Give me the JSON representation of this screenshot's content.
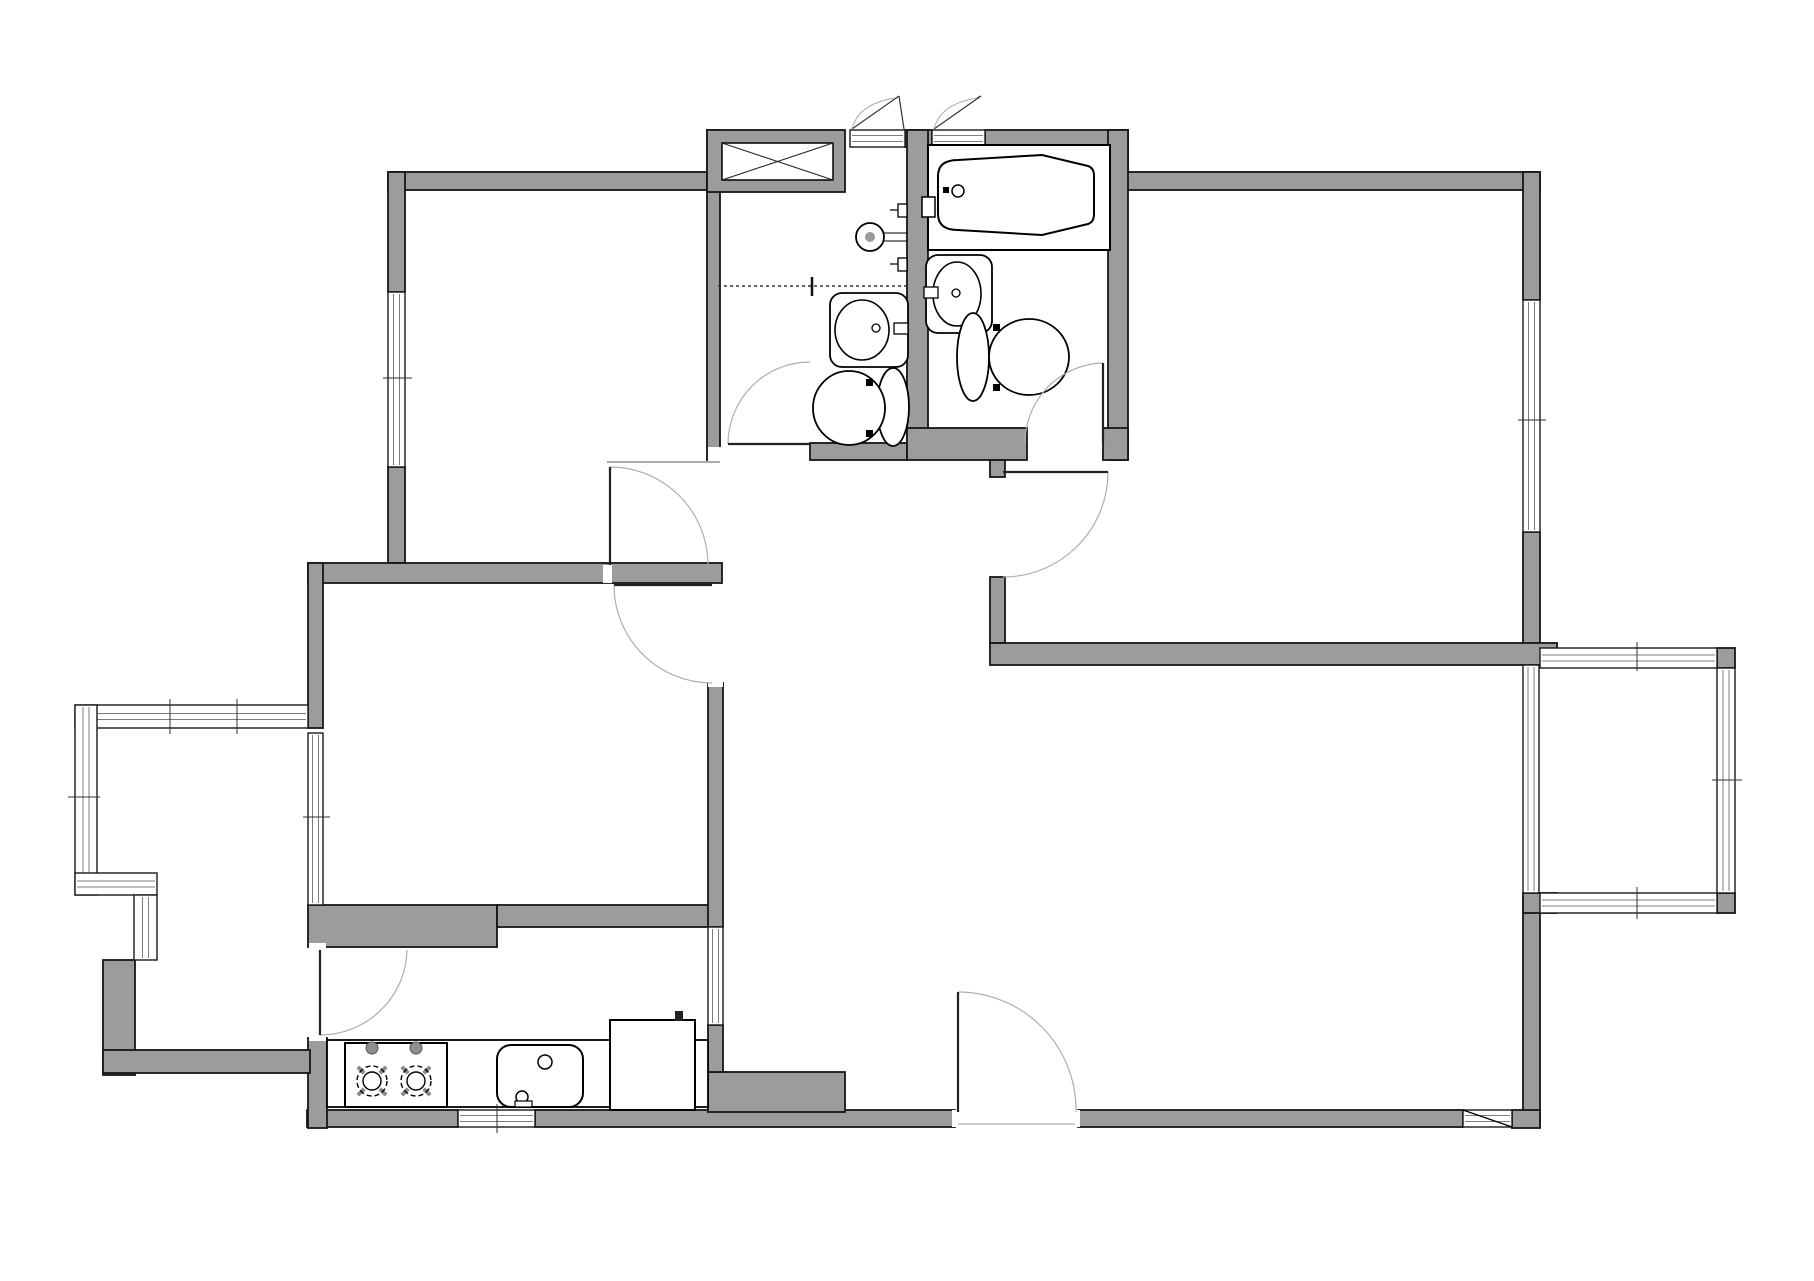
{
  "meta": {
    "kind": "architectural-floor-plan",
    "canvas_w": 1814,
    "canvas_h": 1281
  },
  "palette": {
    "wall_fill": "#9c9c9c",
    "wall_stroke": "#161616",
    "window_fill": "#ffffff",
    "window_stroke": "#1a1a1a",
    "glass_line": "#7d7d7d",
    "door_arc": "#aeaeae",
    "leaf_stroke": "#222222",
    "fixture_stroke": "#000000",
    "fixture_fill": "#ffffff",
    "tick_stroke": "#333333",
    "faint": "#999999",
    "knob_fill": "#8f8f8f",
    "burner_tick": "#8a8a8a"
  },
  "plan": {
    "walls": [
      {
        "x": 388,
        "y": 172,
        "w": 319,
        "h": 18,
        "n": "bedroom1-north-wall"
      },
      {
        "x": 388,
        "y": 172,
        "w": 17,
        "h": 120,
        "n": "bedroom1-west-wall-upper"
      },
      {
        "x": 388,
        "y": 467,
        "w": 17,
        "h": 96,
        "n": "bedroom1-west-wall-lower"
      },
      {
        "x": 308,
        "y": 563,
        "w": 414,
        "h": 20,
        "n": "bedroom1-south-wall"
      },
      {
        "x": 308,
        "y": 563,
        "w": 15,
        "h": 165,
        "n": "bedroom2-west-wall"
      },
      {
        "x": 707,
        "y": 130,
        "w": 13,
        "h": 330,
        "n": "bath-column-west-wall"
      },
      {
        "x": 707,
        "y": 130,
        "w": 138,
        "h": 62,
        "n": "duct-closet-block"
      },
      {
        "x": 905,
        "y": 130,
        "w": 27,
        "h": 17,
        "n": "bath-top-wall-stub"
      },
      {
        "x": 985,
        "y": 130,
        "w": 143,
        "h": 17,
        "n": "bath2-top-wall"
      },
      {
        "x": 1110,
        "y": 130,
        "w": 18,
        "h": 60,
        "n": "top-step-wall"
      },
      {
        "x": 1110,
        "y": 172,
        "w": 430,
        "h": 18,
        "n": "master-north-wall"
      },
      {
        "x": 1523,
        "y": 172,
        "w": 17,
        "h": 128,
        "n": "east-wall-upper"
      },
      {
        "x": 1523,
        "y": 532,
        "w": 17,
        "h": 116,
        "n": "east-wall-mid"
      },
      {
        "x": 990,
        "y": 643,
        "w": 567,
        "h": 22,
        "n": "master-south-wall"
      },
      {
        "x": 990,
        "y": 577,
        "w": 15,
        "h": 66,
        "n": "master-west-stub-wall"
      },
      {
        "x": 1108,
        "y": 130,
        "w": 20,
        "h": 330,
        "n": "bath2-east-wall"
      },
      {
        "x": 907,
        "y": 130,
        "w": 21,
        "h": 313,
        "n": "bath-dividing-wall"
      },
      {
        "x": 810,
        "y": 443,
        "w": 97,
        "h": 17,
        "n": "bath1-south-wall"
      },
      {
        "x": 907,
        "y": 428,
        "w": 120,
        "h": 32,
        "n": "bath2-south-wall"
      },
      {
        "x": 1103,
        "y": 428,
        "w": 25,
        "h": 32,
        "n": "bath2-se-corner"
      },
      {
        "x": 990,
        "y": 460,
        "w": 15,
        "h": 17,
        "n": "master-door-jamb"
      },
      {
        "x": 1523,
        "y": 897,
        "w": 17,
        "h": 230,
        "n": "east-wall-lower"
      },
      {
        "x": 1078,
        "y": 1110,
        "w": 385,
        "h": 17,
        "n": "south-wall-right"
      },
      {
        "x": 1512,
        "y": 1110,
        "w": 28,
        "h": 18,
        "n": "south-wall-se-corner"
      },
      {
        "x": 535,
        "y": 1110,
        "w": 420,
        "h": 17,
        "n": "south-wall-center"
      },
      {
        "x": 708,
        "y": 1072,
        "w": 137,
        "h": 40,
        "n": "entry-step-block"
      },
      {
        "x": 307,
        "y": 1110,
        "w": 151,
        "h": 17,
        "n": "kitchen-south-wall"
      },
      {
        "x": 308,
        "y": 905,
        "w": 189,
        "h": 42,
        "n": "bedroom2-south-wall-left"
      },
      {
        "x": 497,
        "y": 905,
        "w": 225,
        "h": 22,
        "n": "bedroom2-south-wall-right"
      },
      {
        "x": 308,
        "y": 1038,
        "w": 19,
        "h": 90,
        "n": "kitchen-west-wall"
      },
      {
        "x": 708,
        "y": 683,
        "w": 15,
        "h": 244,
        "n": "bedroom2-east-wall"
      },
      {
        "x": 708,
        "y": 1025,
        "w": 15,
        "h": 47,
        "n": "kitchen-east-wall"
      },
      {
        "x": 103,
        "y": 960,
        "w": 32,
        "h": 115,
        "n": "corridor-west-wall"
      },
      {
        "x": 103,
        "y": 1050,
        "w": 207,
        "h": 23,
        "n": "corridor-south-wall"
      },
      {
        "x": 1717,
        "y": 648,
        "w": 18,
        "h": 20,
        "n": "rbalcony-ne-post"
      },
      {
        "x": 1717,
        "y": 893,
        "w": 18,
        "h": 20,
        "n": "rbalcony-se-post"
      },
      {
        "x": 1523,
        "y": 893,
        "w": 34,
        "h": 20,
        "n": "rbalcony-sw-post"
      }
    ],
    "windows": [
      {
        "x": 388,
        "y": 292,
        "w": 17,
        "h": 175,
        "o": "v",
        "n": "bedroom1-west-window"
      },
      {
        "x": 1523,
        "y": 300,
        "w": 17,
        "h": 232,
        "o": "v",
        "n": "master-east-window"
      },
      {
        "x": 458,
        "y": 1110,
        "w": 77,
        "h": 17,
        "o": "h",
        "n": "kitchen-south-window"
      },
      {
        "x": 1463,
        "y": 1110,
        "w": 49,
        "h": 17,
        "o": "h",
        "n": "living-south-window"
      },
      {
        "x": 708,
        "y": 927,
        "w": 15,
        "h": 98,
        "o": "v",
        "n": "kitchen-east-window"
      },
      {
        "x": 850,
        "y": 130,
        "w": 55,
        "h": 17,
        "o": "h",
        "n": "bath1-top-threshold"
      },
      {
        "x": 932,
        "y": 130,
        "w": 53,
        "h": 17,
        "o": "h",
        "n": "bath2-top-threshold"
      },
      {
        "x": 75,
        "y": 705,
        "w": 233,
        "h": 23,
        "o": "h",
        "n": "lbalcony-north-glazing"
      },
      {
        "x": 75,
        "y": 705,
        "w": 22,
        "h": 190,
        "o": "v",
        "n": "lbalcony-west-glazing"
      },
      {
        "x": 75,
        "y": 873,
        "w": 82,
        "h": 22,
        "o": "h",
        "n": "lbalcony-south-glazing"
      },
      {
        "x": 134,
        "y": 895,
        "w": 23,
        "h": 65,
        "o": "v",
        "n": "lbalcony-return-glazing"
      },
      {
        "x": 308,
        "y": 733,
        "w": 15,
        "h": 172,
        "o": "v",
        "n": "bedroom2-balcony-window"
      },
      {
        "x": 1540,
        "y": 648,
        "w": 177,
        "h": 20,
        "o": "h",
        "n": "rbalcony-north-glazing"
      },
      {
        "x": 1717,
        "y": 668,
        "w": 18,
        "h": 225,
        "o": "v",
        "n": "rbalcony-east-glazing"
      },
      {
        "x": 1540,
        "y": 893,
        "w": 177,
        "h": 20,
        "o": "h",
        "n": "rbalcony-south-glazing"
      },
      {
        "x": 1523,
        "y": 665,
        "w": 16,
        "h": 228,
        "o": "v",
        "n": "living-balcony-glazing"
      }
    ],
    "thresholds": [
      {
        "x": 708,
        "y": 447,
        "w": 20,
        "h": 15
      },
      {
        "x": 603,
        "y": 565,
        "w": 9,
        "h": 18
      },
      {
        "x": 708,
        "y": 679,
        "w": 15,
        "h": 8
      },
      {
        "x": 309,
        "y": 943,
        "w": 17,
        "h": 8
      },
      {
        "x": 309,
        "y": 1033,
        "w": 17,
        "h": 8
      },
      {
        "x": 952,
        "y": 1110,
        "w": 10,
        "h": 17
      },
      {
        "x": 1070,
        "y": 1110,
        "w": 10,
        "h": 17
      }
    ],
    "doors": [
      {
        "n": "bathroom1-door",
        "leaf": [
          810,
          444,
          728,
          444
        ],
        "arc": "M728 444 A82 82 0 0 1 810 362"
      },
      {
        "n": "bedroom1-door",
        "leaf": [
          610,
          565,
          610,
          467
        ],
        "arc": "M610 467 A98 98 0 0 1 708 565"
      },
      {
        "n": "bedroom2-door",
        "leaf": [
          712,
          585,
          614,
          585
        ],
        "arc": "M614 585 A98 98 0 0 0 712 683"
      },
      {
        "n": "master-suite-door",
        "leaf": [
          1003,
          472,
          1108,
          472
        ],
        "arc": "M1108 472 A105 105 0 0 1 1003 577"
      },
      {
        "n": "ensuite-bath-door",
        "leaf": [
          1103,
          443,
          1103,
          363
        ],
        "arc": "M1103 363 A80 80 0 0 0 1025 443"
      },
      {
        "n": "kitchen-door",
        "leaf": [
          320,
          950,
          320,
          1035
        ],
        "arc": "M320 1035 A87 87 0 0 0 407 950"
      },
      {
        "n": "entry-door",
        "leaf": [
          958,
          1112,
          958,
          992
        ],
        "arc": "M958 992 A118 118 0 0 1 1076 1112"
      }
    ],
    "casements": [
      {
        "n": "bath1-top-vent",
        "lines": [
          [
            852,
            129,
            899,
            96
          ],
          [
            899,
            96,
            904,
            129
          ]
        ],
        "curve": "M852 129 Q858 104 895 98"
      },
      {
        "n": "bath2-top-vent",
        "lines": [
          [
            934,
            129,
            981,
            96
          ],
          [
            981,
            96,
            977,
            98
          ]
        ],
        "curve": "M934 129 Q940 104 977 98"
      }
    ],
    "lines": [
      {
        "x1": 718,
        "y1": 286,
        "x2": 907,
        "y2": 286,
        "sw": 1.5,
        "c": "#333333",
        "dash": "3 3",
        "n": "bath1-shower-divider"
      },
      {
        "x1": 812,
        "y1": 277,
        "x2": 812,
        "y2": 296,
        "sw": 2.5,
        "c": "#111111",
        "n": "divider-tick"
      },
      {
        "x1": 930,
        "y1": 240,
        "x2": 1108,
        "y2": 240,
        "sw": 1,
        "c": "#333333",
        "dash": "3 3",
        "n": "tub-apron-line"
      },
      {
        "x1": 607,
        "y1": 462,
        "x2": 720,
        "y2": 462,
        "sw": 1,
        "c": "#555555",
        "n": "hall-partition-line"
      },
      {
        "x1": 958,
        "y1": 1124,
        "x2": 1075,
        "y2": 1124,
        "sw": 1,
        "c": "#999999",
        "n": "entry-threshold-line"
      },
      {
        "x1": 1463,
        "y1": 1110,
        "x2": 1512,
        "y2": 1127,
        "sw": 1.2,
        "c": "#000000",
        "n": "window-diagonal"
      },
      {
        "x1": 884,
        "y1": 233,
        "x2": 907,
        "y2": 233,
        "sw": 1,
        "c": "#000000",
        "n": "shower-pipe-a"
      },
      {
        "x1": 884,
        "y1": 241,
        "x2": 907,
        "y2": 241,
        "sw": 1,
        "c": "#000000",
        "n": "shower-pipe-b"
      },
      {
        "x1": 610,
        "y1": 1028,
        "x2": 695,
        "y2": 1028,
        "sw": 1,
        "c": "#000000",
        "n": "appliance-line-a"
      },
      {
        "x1": 610,
        "y1": 1038,
        "x2": 695,
        "y2": 1038,
        "sw": 1,
        "c": "#000000",
        "n": "appliance-line-b"
      },
      {
        "x1": 890,
        "y1": 210,
        "x2": 898,
        "y2": 210,
        "sw": 1.2,
        "c": "#000000",
        "n": "handle-stem-a"
      },
      {
        "x1": 890,
        "y1": 264,
        "x2": 898,
        "y2": 264,
        "sw": 1.2,
        "c": "#000000",
        "n": "handle-stem-b"
      },
      {
        "x1": 894,
        "y1": 328,
        "x2": 878,
        "y2": 328,
        "sw": 1.4,
        "c": "#000000",
        "n": "sink1-spout"
      },
      {
        "x1": 938,
        "y1": 293,
        "x2": 954,
        "y2": 293,
        "sw": 1.4,
        "c": "#000000",
        "n": "sink2-spout"
      },
      {
        "x1": 534,
        "y1": 1058,
        "x2": 521,
        "y2": 1095,
        "sw": 3,
        "c": "#000000",
        "n": "ksink-lever"
      }
    ],
    "fixtures": [
      {
        "t": "rect",
        "x": 928,
        "y": 145,
        "w": 182,
        "h": 105,
        "sw": 2,
        "n": "bathtub-platform"
      },
      {
        "t": "path",
        "d": "M958 160 L1042 155 L1088 166 Q1094 168 1094 176 L1094 214 Q1094 222 1088 224 L1042 235 L958 230 Q938 230 938 214 L938 176 Q938 160 958 160 Z",
        "sw": 2,
        "n": "bathtub"
      },
      {
        "t": "circle",
        "cx": 958,
        "cy": 191,
        "r": 6,
        "sw": 1.5,
        "n": "tub-drain"
      },
      {
        "t": "rect",
        "x": 943,
        "y": 187,
        "w": 6,
        "h": 6,
        "fill": "#000000",
        "sw": 0,
        "n": "tub-dot"
      },
      {
        "t": "rect",
        "x": 922,
        "y": 197,
        "w": 13,
        "h": 20,
        "sw": 1.5,
        "n": "tub-faucet"
      },
      {
        "t": "circle",
        "cx": 870,
        "cy": 237,
        "r": 14,
        "sw": 1.8,
        "n": "shower-drain"
      },
      {
        "t": "circle",
        "cx": 870,
        "cy": 237,
        "r": 5,
        "fill": "#999999",
        "sw": 0,
        "n": "shower-drain-dot"
      },
      {
        "t": "rect",
        "x": 898,
        "y": 204,
        "w": 9,
        "h": 13,
        "sw": 1.3,
        "n": "shower-handle-a"
      },
      {
        "t": "rect",
        "x": 898,
        "y": 258,
        "w": 9,
        "h": 13,
        "sw": 1.3,
        "n": "shower-handle-b"
      },
      {
        "t": "rect",
        "x": 830,
        "y": 293,
        "w": 78,
        "h": 74,
        "rx": 12,
        "sw": 1.8,
        "n": "bath1-vanity"
      },
      {
        "t": "ellipse",
        "cx": 862,
        "cy": 330,
        "rx": 27,
        "ry": 30,
        "sw": 1.6,
        "n": "bath1-basin"
      },
      {
        "t": "rect",
        "x": 894,
        "y": 323,
        "w": 14,
        "h": 11,
        "sw": 1.3,
        "n": "bath1-faucet"
      },
      {
        "t": "circle",
        "cx": 876,
        "cy": 328,
        "r": 4,
        "sw": 1.3,
        "n": "bath1-faucet-knob"
      },
      {
        "t": "rect",
        "x": 926,
        "y": 255,
        "w": 66,
        "h": 78,
        "rx": 12,
        "sw": 1.8,
        "n": "bath2-vanity"
      },
      {
        "t": "ellipse",
        "cx": 957,
        "cy": 294,
        "rx": 24,
        "ry": 32,
        "sw": 1.6,
        "n": "bath2-basin"
      },
      {
        "t": "rect",
        "x": 924,
        "y": 287,
        "w": 14,
        "h": 11,
        "sw": 1.3,
        "n": "bath2-faucet"
      },
      {
        "t": "circle",
        "cx": 956,
        "cy": 293,
        "r": 4,
        "sw": 1.3,
        "n": "bath2-faucet-knob"
      },
      {
        "t": "ellipse",
        "cx": 893,
        "cy": 407,
        "rx": 16,
        "ry": 39,
        "sw": 1.8,
        "n": "toilet1-tank"
      },
      {
        "t": "ellipse",
        "cx": 849,
        "cy": 408,
        "rx": 36,
        "ry": 37,
        "sw": 1.8,
        "n": "toilet1-bowl"
      },
      {
        "t": "rect",
        "x": 866,
        "y": 379,
        "w": 7,
        "h": 7,
        "fill": "#000000",
        "sw": 0,
        "n": "toilet1-hinge-a"
      },
      {
        "t": "rect",
        "x": 866,
        "y": 430,
        "w": 7,
        "h": 7,
        "fill": "#000000",
        "sw": 0,
        "n": "toilet1-hinge-b"
      },
      {
        "t": "ellipse",
        "cx": 973,
        "cy": 357,
        "rx": 16,
        "ry": 44,
        "sw": 1.8,
        "n": "toilet2-tank"
      },
      {
        "t": "ellipse",
        "cx": 1029,
        "cy": 357,
        "rx": 40,
        "ry": 38,
        "sw": 1.8,
        "n": "toilet2-bowl"
      },
      {
        "t": "rect",
        "x": 993,
        "y": 324,
        "w": 7,
        "h": 7,
        "fill": "#000000",
        "sw": 0,
        "n": "toilet2-hinge-a"
      },
      {
        "t": "rect",
        "x": 993,
        "y": 384,
        "w": 7,
        "h": 7,
        "fill": "#000000",
        "sw": 0,
        "n": "toilet2-hinge-b"
      },
      {
        "t": "rect",
        "x": 327,
        "y": 1040,
        "w": 381,
        "h": 67,
        "sw": 1.8,
        "n": "kitchen-counter"
      },
      {
        "t": "rect",
        "x": 345,
        "y": 1043,
        "w": 102,
        "h": 64,
        "sw": 2,
        "n": "cooktop"
      },
      {
        "t": "circle",
        "cx": 372,
        "cy": 1048,
        "r": 6,
        "fill": "#8f8f8f",
        "sw": 1,
        "stroke": "#555555",
        "n": "cooktop-knob-a"
      },
      {
        "t": "circle",
        "cx": 416,
        "cy": 1048,
        "r": 6,
        "fill": "#8f8f8f",
        "sw": 1,
        "stroke": "#555555",
        "n": "cooktop-knob-b"
      },
      {
        "t": "burner",
        "cx": 372,
        "cy": 1081,
        "r": 15,
        "n": "burner-left"
      },
      {
        "t": "burner",
        "cx": 416,
        "cy": 1081,
        "r": 15,
        "n": "burner-right"
      },
      {
        "t": "rect",
        "x": 497,
        "y": 1045,
        "w": 86,
        "h": 62,
        "rx": 14,
        "sw": 2,
        "n": "kitchen-sink"
      },
      {
        "t": "circle",
        "cx": 545,
        "cy": 1062,
        "r": 7,
        "sw": 1.5,
        "n": "ksink-faucet"
      },
      {
        "t": "circle",
        "cx": 522,
        "cy": 1097,
        "r": 6,
        "sw": 1.5,
        "n": "ksink-drain"
      },
      {
        "t": "rect",
        "x": 515,
        "y": 1101,
        "w": 17,
        "h": 6,
        "sw": 1.2,
        "n": "ksink-strainer"
      },
      {
        "t": "rect",
        "x": 610,
        "y": 1020,
        "w": 85,
        "h": 90,
        "sw": 2,
        "n": "appliance-box"
      },
      {
        "t": "rect",
        "x": 675,
        "y": 1011,
        "w": 8,
        "h": 10,
        "fill": "#222222",
        "sw": 0,
        "n": "appliance-handle"
      },
      {
        "t": "rect",
        "x": 722,
        "y": 143,
        "w": 111,
        "h": 37,
        "sw": 1.5,
        "n": "duct-shaft-box"
      }
    ],
    "xlines": [
      {
        "x1": 722,
        "y1": 143,
        "x2": 833,
        "y2": 180,
        "n": "shaft-x-a"
      },
      {
        "x1": 722,
        "y1": 180,
        "x2": 833,
        "y2": 143,
        "n": "shaft-x-b"
      }
    ],
    "ticks": [
      {
        "x1": 383,
        "y1": 378,
        "x2": 412,
        "y2": 378
      },
      {
        "x1": 68,
        "y1": 797,
        "x2": 100,
        "y2": 797
      },
      {
        "x1": 170,
        "y1": 699,
        "x2": 170,
        "y2": 734
      },
      {
        "x1": 237,
        "y1": 699,
        "x2": 237,
        "y2": 734
      },
      {
        "x1": 303,
        "y1": 817,
        "x2": 330,
        "y2": 817
      },
      {
        "x1": 1518,
        "y1": 420,
        "x2": 1546,
        "y2": 420
      },
      {
        "x1": 1637,
        "y1": 642,
        "x2": 1637,
        "y2": 671
      },
      {
        "x1": 1712,
        "y1": 780,
        "x2": 1742,
        "y2": 780
      },
      {
        "x1": 1637,
        "y1": 887,
        "x2": 1637,
        "y2": 919
      },
      {
        "x1": 497,
        "y1": 1104,
        "x2": 497,
        "y2": 1133
      }
    ]
  }
}
